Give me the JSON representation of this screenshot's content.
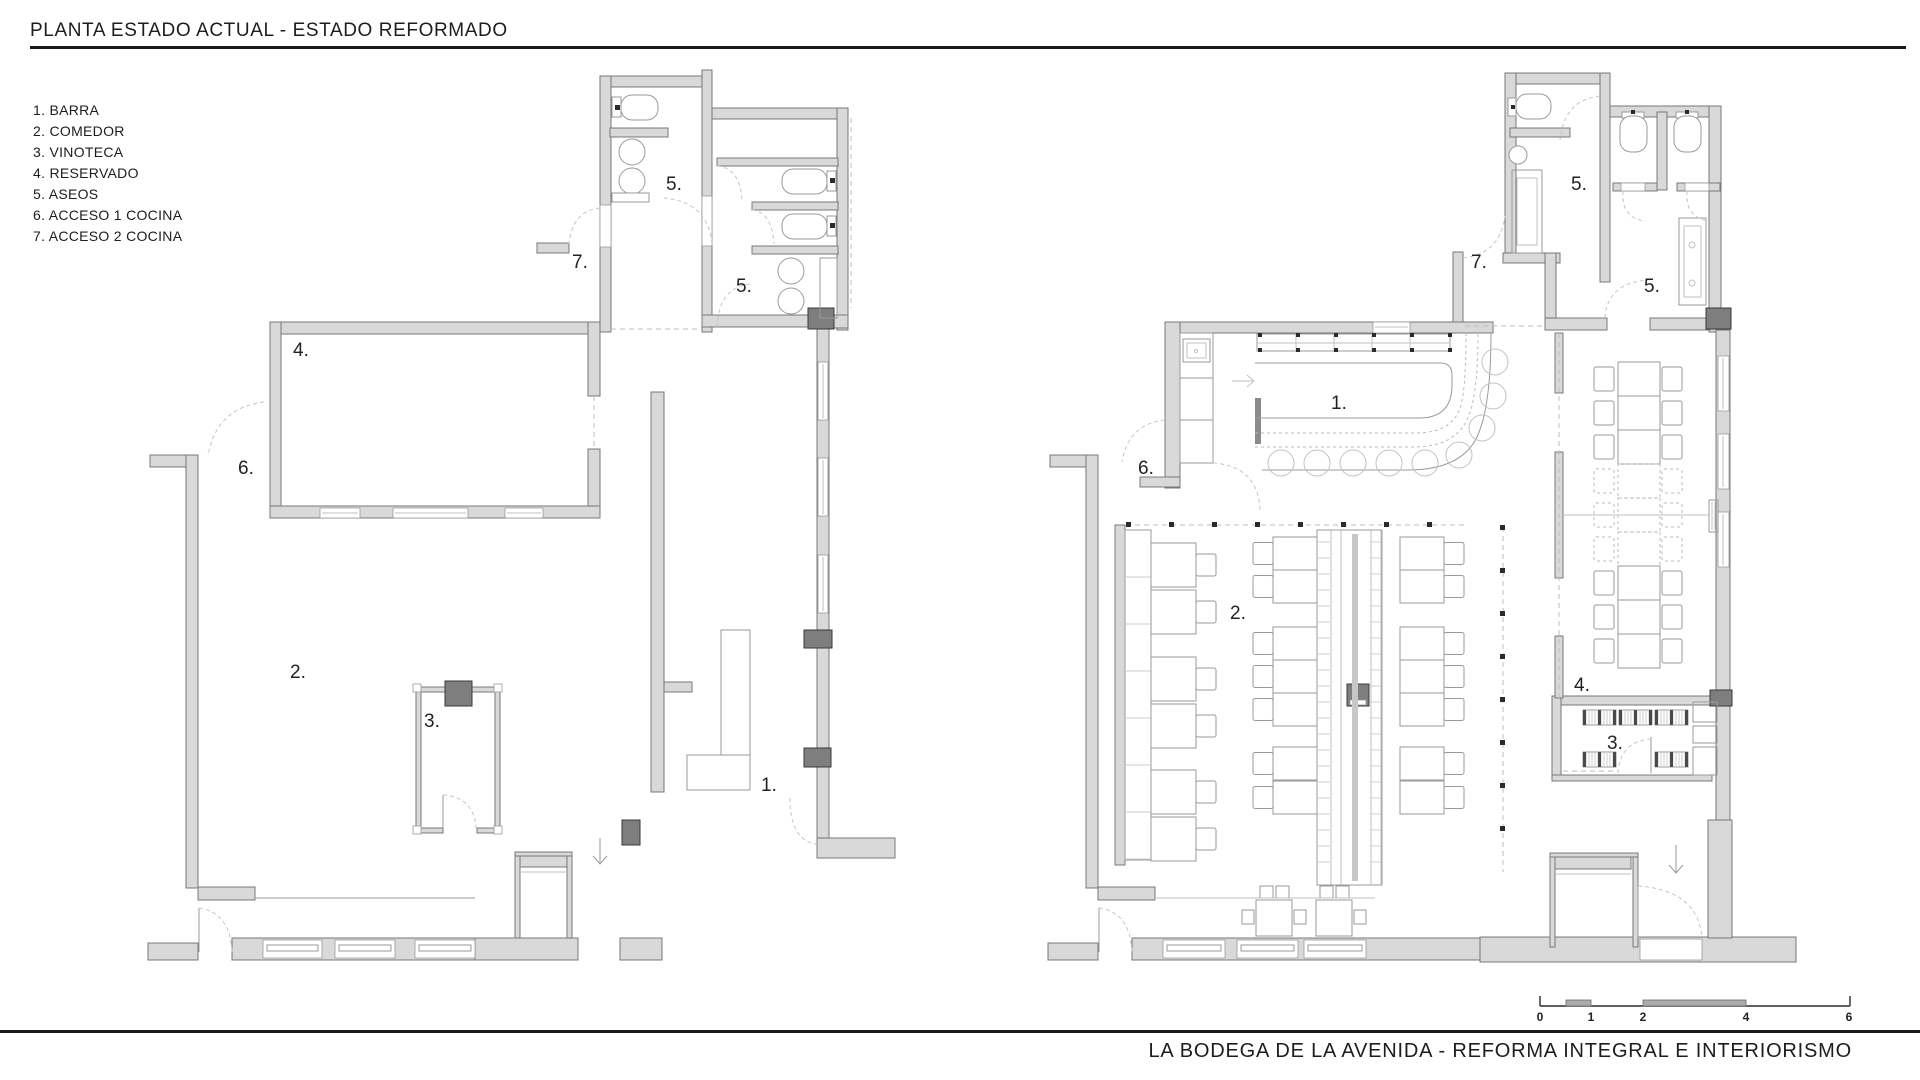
{
  "header": {
    "title": "PLANTA ESTADO ACTUAL - ESTADO REFORMADO"
  },
  "legend": {
    "items": [
      "1. BARRA",
      "2. COMEDOR",
      "3. VINOTECA",
      "4. RESERVADO",
      "5. ASEOS",
      "6. ACCESO 1 COCINA",
      "7. ACCESO 2 COCINA"
    ]
  },
  "room_labels": {
    "barra": "1.",
    "comedor": "2.",
    "vinoteca": "3.",
    "reservado": "4.",
    "aseos": "5.",
    "acceso_1_cocina": "6.",
    "acceso_2_cocina": "7."
  },
  "scale_bar": {
    "ticks": [
      "0",
      "1",
      "2",
      "4",
      "6"
    ]
  },
  "footer": {
    "project_title": "LA BODEGA DE LA AVENIDA - REFORMA INTEGRAL E INTERIORISMO"
  },
  "colors": {
    "wall_fill": "#d9d9d9",
    "wall_edge": "#787878",
    "pillar": "#7e7e7e",
    "ink": "#1d1d1d",
    "furniture_line": "#9a9a9a"
  }
}
